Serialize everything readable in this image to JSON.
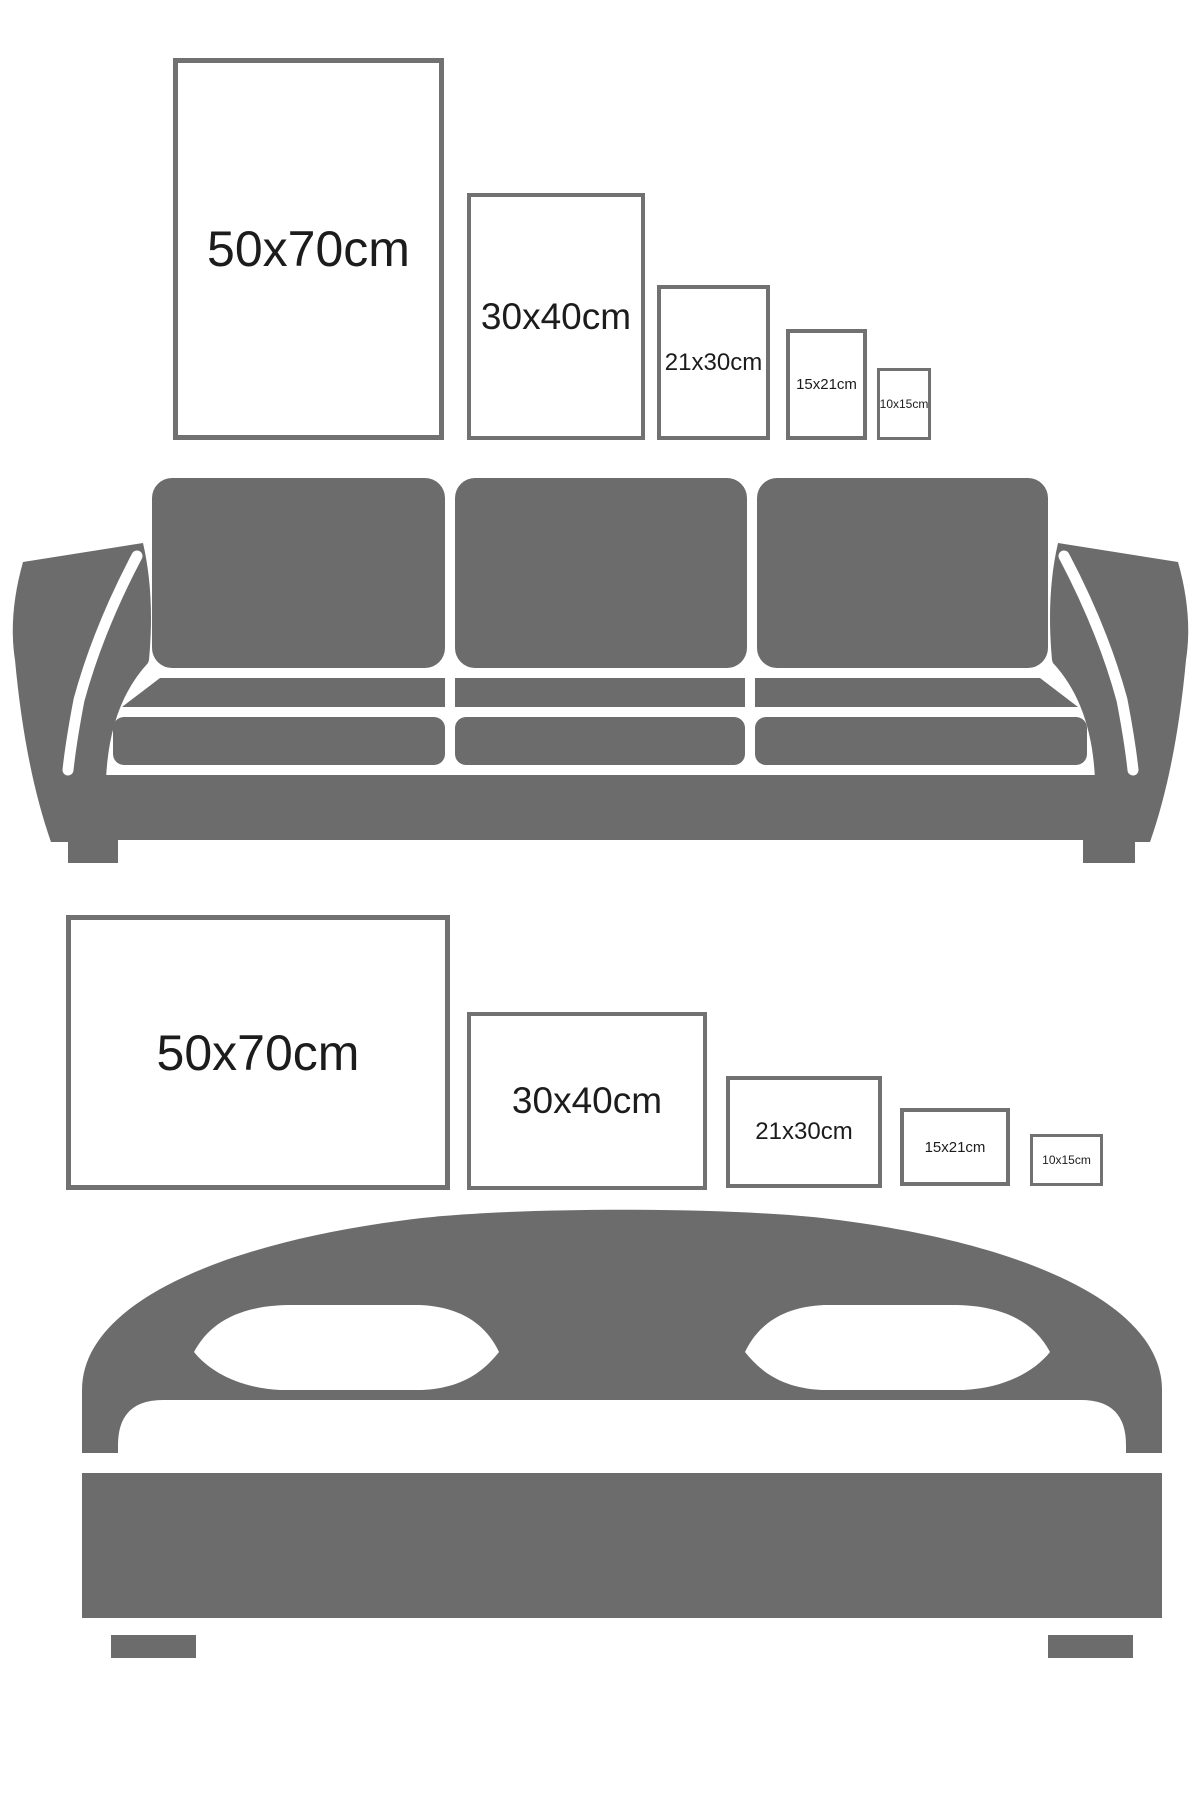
{
  "colors": {
    "background": "#ffffff",
    "furniture_gray": "#6c6c6c",
    "frame_border_gray": "#717171",
    "label_text": "#1c1c1c"
  },
  "portrait_section": {
    "description": "portrait frame sizes above sofa",
    "frames": [
      {
        "label": "50x70cm"
      },
      {
        "label": "30x40cm"
      },
      {
        "label": "21x30cm"
      },
      {
        "label": "15x21cm"
      },
      {
        "label": "10x15cm"
      }
    ]
  },
  "landscape_section": {
    "description": "landscape frame sizes above bed",
    "frames": [
      {
        "label": "50x70cm"
      },
      {
        "label": "30x40cm"
      },
      {
        "label": "21x30cm"
      },
      {
        "label": "15x21cm"
      },
      {
        "label": "10x15cm"
      }
    ]
  },
  "illustrations": {
    "sofa": "three-seat-sofa-silhouette-icon",
    "bed": "double-bed-silhouette-icon"
  }
}
